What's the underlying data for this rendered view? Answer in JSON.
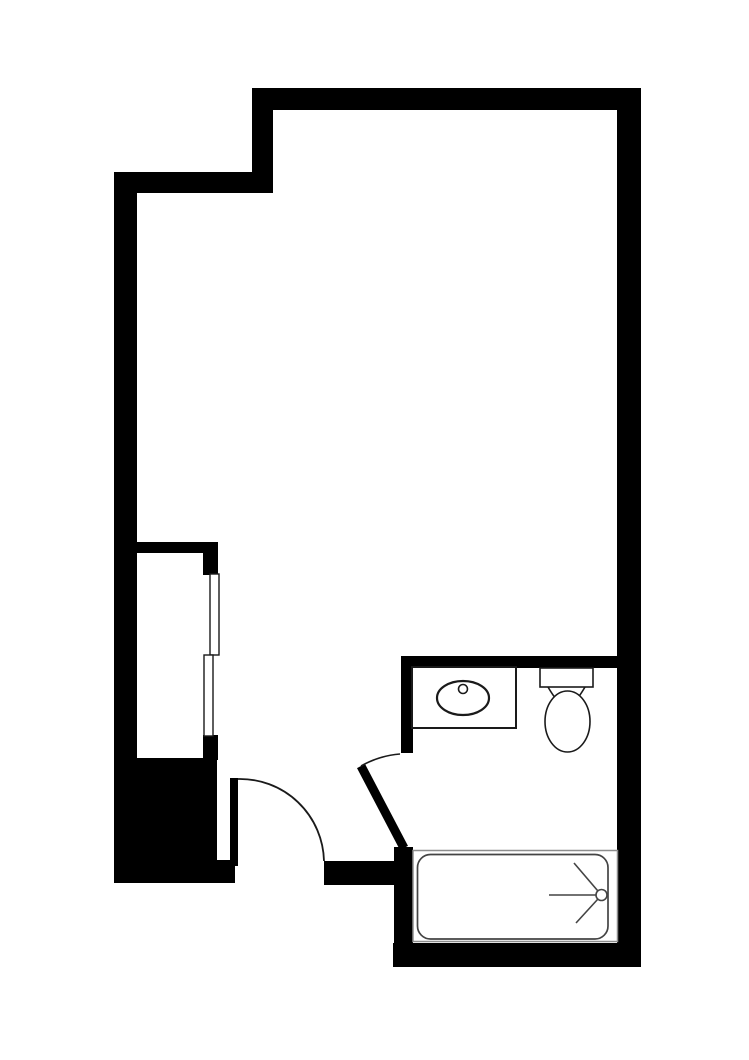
{
  "page": {
    "kind": "black-and-white architectural floor plan of a studio apartment unit",
    "visible_text": []
  },
  "colors": {
    "background": "#ffffff",
    "wall": "#000000",
    "fixture": "#1a1a1a",
    "tub": "#444444",
    "alcove": "#8d8d8d",
    "fill_white": "#ffffff"
  },
  "fixtures": {
    "entry_door": "hinged entry door leaf with quarter-circle swing arc at bottom center",
    "bathroom_door": "angled open door leaf with short swing arc into bathroom",
    "closet_doors": "two offset bypass sliding panels on closet opening",
    "sink": "oval basin with round faucet dot set in rectangular vanity counter",
    "toilet": "rectangular tank with elongated egg-shaped bowl",
    "bathtub": "rounded-corner tub in alcove with shower-head spray symbol"
  }
}
